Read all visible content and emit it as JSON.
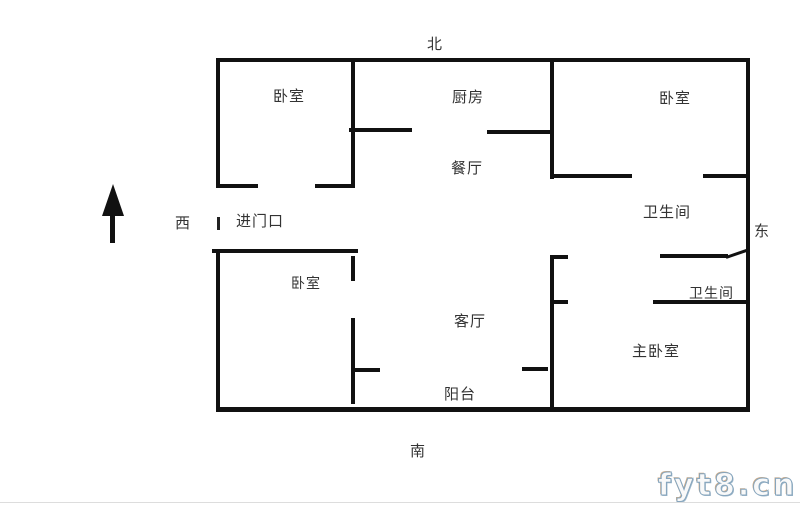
{
  "compass": {
    "north": "北",
    "south": "南",
    "west": "西",
    "east": "东"
  },
  "labels": {
    "bedroom_top_left": "卧室",
    "kitchen": "厨房",
    "dining_room": "餐厅",
    "bedroom_top_right": "卧室",
    "bathroom_upper": "卫生间",
    "bathroom_lower": "卫生间",
    "bedroom_lower_left": "卧室",
    "living_room": "客厅",
    "master_bedroom": "主卧室",
    "balcony": "阳台",
    "entrance": "进门口"
  },
  "watermark": "fyt8.cn",
  "colors": {
    "wall": "#111111",
    "text": "#333333",
    "watermark_stroke": "#86a5bd",
    "watermark_accent": "#cdab88",
    "page_line": "#dddddd"
  }
}
